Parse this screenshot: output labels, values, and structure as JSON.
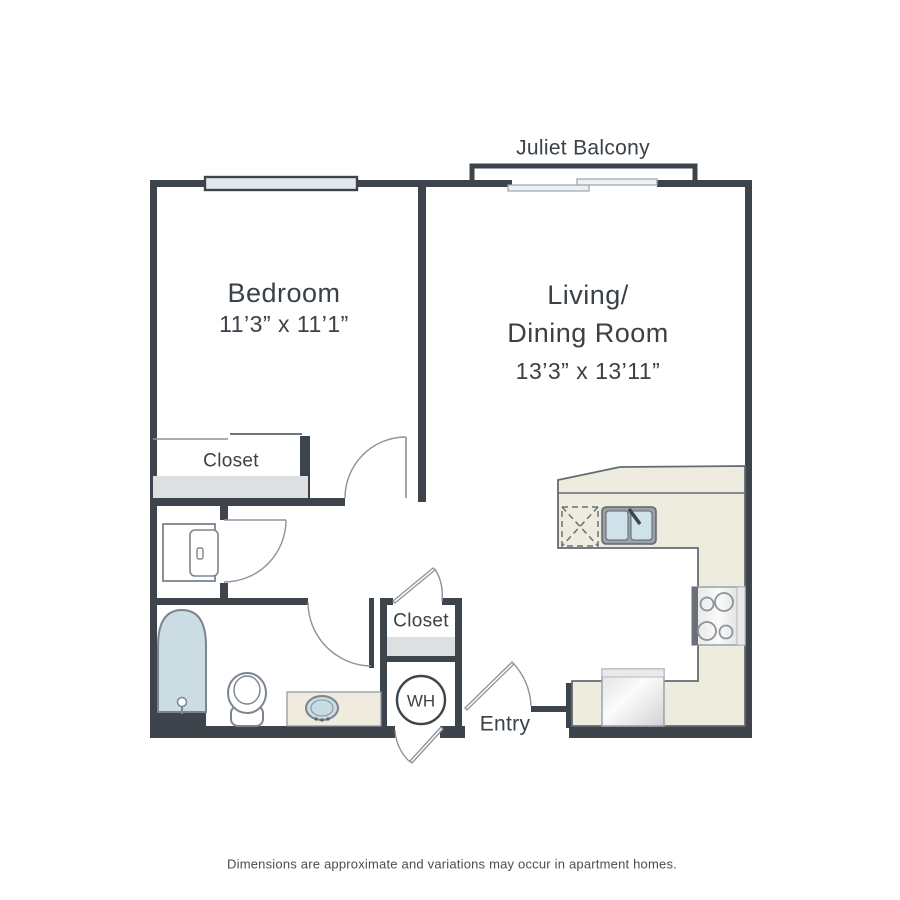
{
  "floor_plan": {
    "labels": {
      "juliet_balcony": "Juliet Balcony",
      "bedroom": {
        "name": "Bedroom",
        "dimensions": "11’3” x 11’1”"
      },
      "living_dining": {
        "name_line1": "Living/",
        "name_line2": "Dining Room",
        "dimensions": "13’3” x 13’11”"
      },
      "bedroom_closet": "Closet",
      "hall_closet": "Closet",
      "water_heater": "WH",
      "entry": "Entry"
    },
    "disclaimer": "Dimensions are approximate and variations may occur in apartment homes.",
    "colors": {
      "wall": "#3e444b",
      "line_gray": "#8b939a",
      "fixture_line": "#7c858d",
      "counter_beige": "#eeebdf",
      "counter_line": "#646b70",
      "water_blue": "#cbdce3",
      "sink_blue": "#cfe1e9",
      "shade_gray": "#dedfe0",
      "window_fill": "#e2e9ed",
      "dash_gray": "#6a7177",
      "text": "#3a4147",
      "footer_text": "#4d4d4d"
    }
  }
}
